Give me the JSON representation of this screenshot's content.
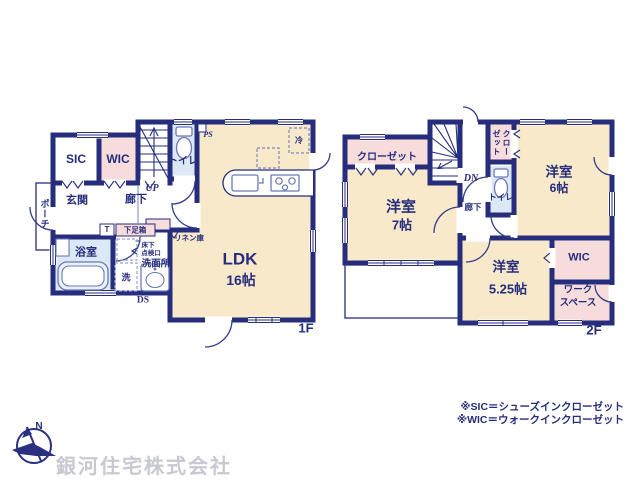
{
  "colors": {
    "wall_navy": "#262d7c",
    "room_cream": "#f8e9cb",
    "room_pink": "#f7dcdc",
    "room_lightblue": "#dce8f5",
    "company_gray": "#c7c8d2"
  },
  "f1": {
    "label": "1F",
    "sic": "SIC",
    "wic": "WIC",
    "toilet": "トイレ",
    "ps": "PS",
    "up": "UP",
    "genkan": "玄関",
    "rouka": "廊下",
    "porch": "ポーチ",
    "t": "T",
    "shoebox": "下足箱",
    "bath": "浴室",
    "underfloor1": "床下",
    "underfloor2": "点検口",
    "washroom": "洗面所",
    "washer": "洗",
    "linen": "リネン庫",
    "ds": "DS",
    "ldk": "LDK",
    "ldk_size": "16帖",
    "fridge": "冷"
  },
  "f2": {
    "label": "2F",
    "closet": "クローゼット",
    "dn": "DN",
    "closet_v1": "クロー",
    "closet_v2": "ゼット",
    "room7": "洋室",
    "room7_size": "7帖",
    "rouka": "廊下",
    "toilet": "トイレ",
    "room6": "洋室",
    "room6_size": "6帖",
    "room525": "洋室",
    "room525_size": "5.25帖",
    "wic": "WIC",
    "work1": "ワーク",
    "work2": "スペース"
  },
  "footer": {
    "company": "銀河住宅株式会社",
    "compass_n": "N",
    "note1": "※SIC＝シューズインクローゼット",
    "note2": "※WIC＝ウォークインクローゼット"
  }
}
